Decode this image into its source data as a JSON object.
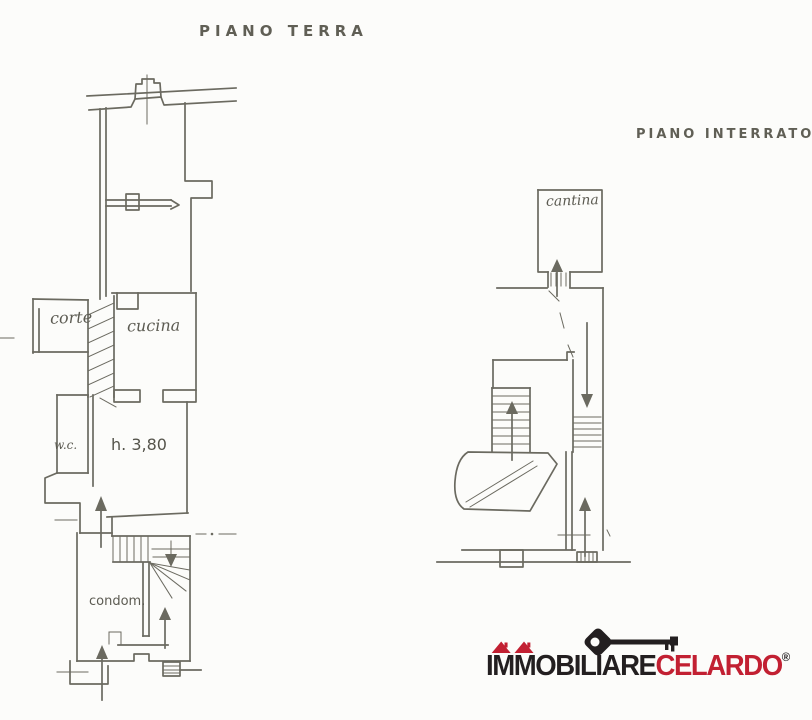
{
  "colors": {
    "paper": "#fcfcfa",
    "ink": "#6b6a60",
    "logo_black": "#231f20",
    "logo_red": "#c22032"
  },
  "plans": {
    "ground_floor": {
      "title": "PIANO TERRA",
      "labels": {
        "corte": "corte",
        "cucina": "cucina",
        "wc": "w.c.",
        "height": "h. 3,80",
        "condominio": "condom."
      }
    },
    "basement": {
      "title": "PIANO INTERRATO",
      "labels": {
        "cantina": "cantina"
      }
    }
  },
  "logo": {
    "name_part1": "IMMOBILIARE",
    "name_part2": "CELARDO",
    "registered_mark": "®",
    "icon": "key-icon"
  }
}
